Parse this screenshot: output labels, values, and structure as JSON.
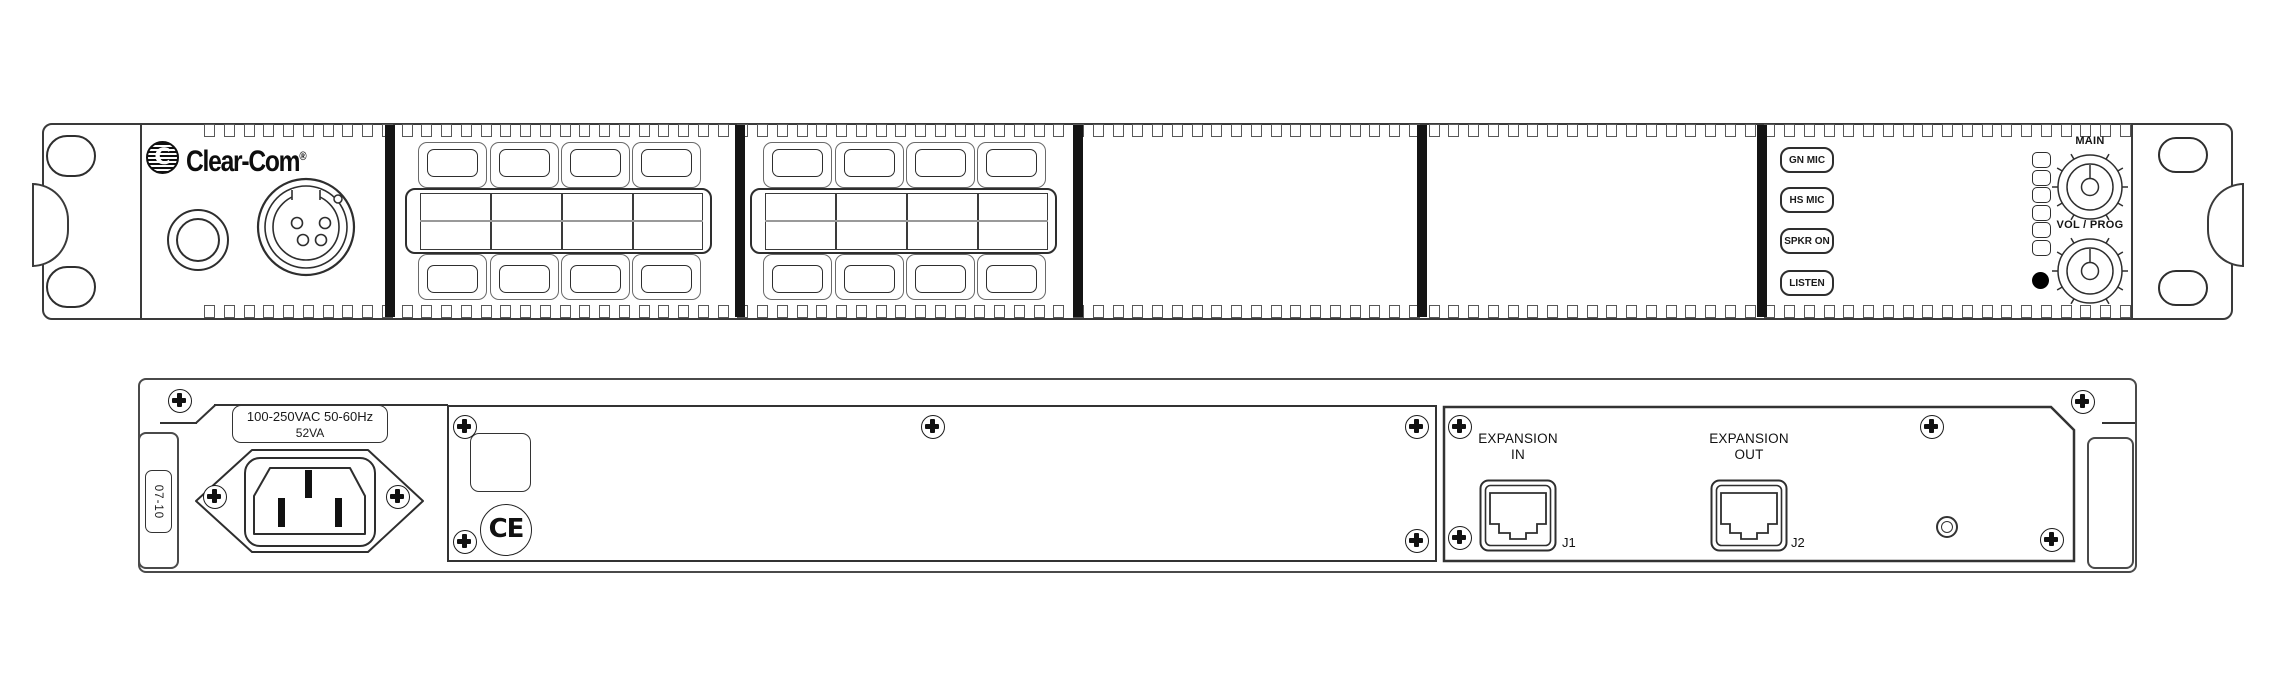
{
  "front": {
    "brand": "Clear-Com",
    "brand_reg": "®",
    "brand_icon_letter": "C",
    "monitor_buttons": [
      "GN MIC",
      "HS MIC",
      "SPKR ON",
      "LISTEN"
    ],
    "knob_main_label": "MAIN",
    "knob_vol_label": "VOL / PROG"
  },
  "rear": {
    "power_rating_line1": "100-250VAC 50-60Hz",
    "power_rating_line2": "52VA",
    "side_label": "07-10",
    "ce_mark": "CE",
    "expansion_in_line1": "EXPANSION",
    "expansion_in_line2": "IN",
    "expansion_in_jack": "J1",
    "expansion_out_line1": "EXPANSION",
    "expansion_out_line2": "OUT",
    "expansion_out_jack": "J2"
  },
  "colors": {
    "line": "#333333",
    "divider_bar": "#141414",
    "background": "#ffffff"
  }
}
